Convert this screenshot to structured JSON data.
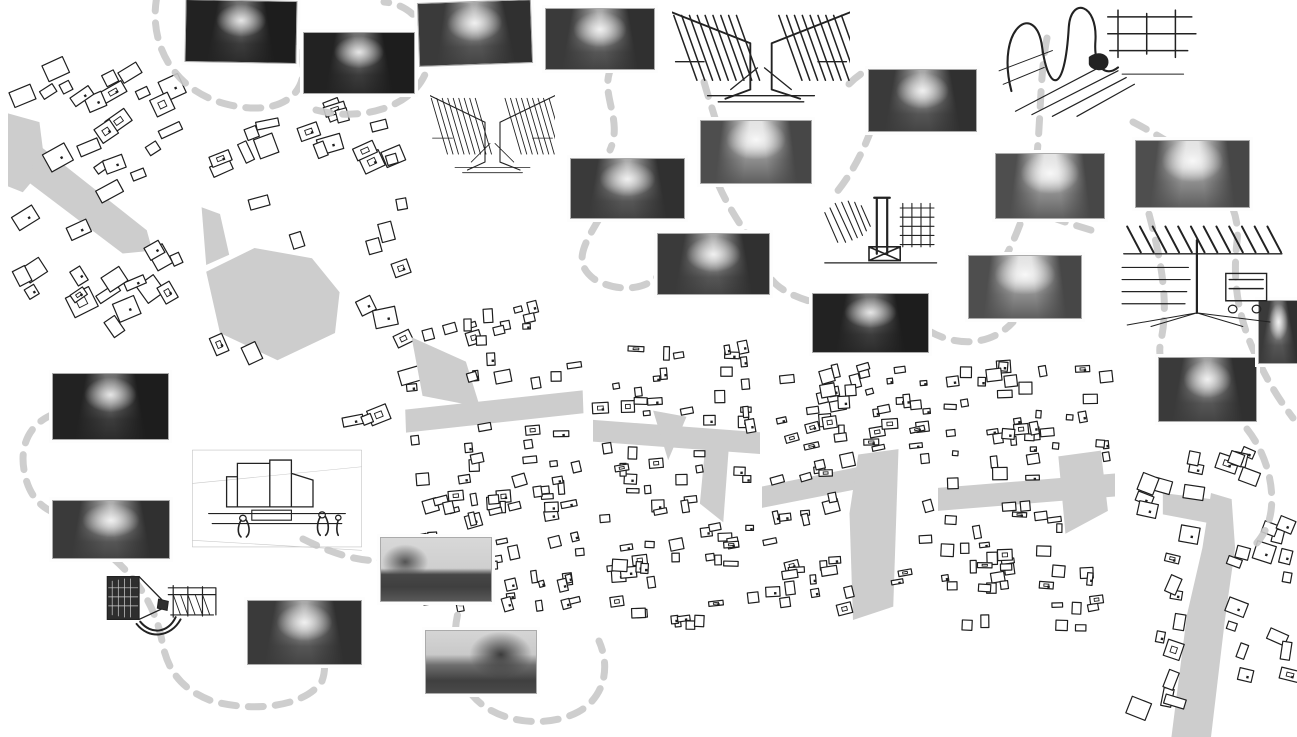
{
  "document": {
    "title": "Urban route analysis collage",
    "description": "Collage of figure-ground urban maps, grayscale street photographs and ink perspective sketches linked by dashed gray route lines",
    "background": "#ffffff"
  },
  "palette": {
    "path_gray": "#c9c9c9",
    "street_gray": "#cdcdcd",
    "ink": "#222222",
    "building_fill": "#ffffff",
    "building_stroke": "#1e1e1e",
    "photo_frame": "#ababab"
  },
  "maps": [
    {
      "id": "figure-ground-map-1",
      "desc": "figure-ground map segment 1, diagonal gray street",
      "x": 8,
      "y": 55,
      "w": 185,
      "h": 292,
      "rot": 0,
      "grain": -28,
      "count": 40,
      "smin": 9,
      "smax": 26,
      "streets": [
        [
          [
            0,
            0.2
          ],
          [
            0.17,
            0.23
          ],
          [
            0.2,
            0.38
          ],
          [
            0.08,
            0.47
          ],
          [
            0,
            0.45
          ]
        ],
        [
          [
            0.15,
            0.3
          ],
          [
            0.75,
            0.6
          ],
          [
            0.78,
            0.67
          ],
          [
            0.62,
            0.68
          ],
          [
            0.12,
            0.44
          ]
        ]
      ]
    },
    {
      "id": "figure-ground-map-2",
      "desc": "figure-ground map segment 2, gray plaza",
      "x": 197,
      "y": 95,
      "w": 230,
      "h": 340,
      "rot": 0,
      "grain": -18,
      "count": 32,
      "smin": 9,
      "smax": 24,
      "streets": [
        [
          [
            0.04,
            0.52
          ],
          [
            0.25,
            0.45
          ],
          [
            0.5,
            0.48
          ],
          [
            0.62,
            0.58
          ],
          [
            0.6,
            0.7
          ],
          [
            0.35,
            0.78
          ],
          [
            0.1,
            0.7
          ]
        ],
        [
          [
            0.02,
            0.33
          ],
          [
            0.1,
            0.35
          ],
          [
            0.14,
            0.47
          ],
          [
            0.04,
            0.5
          ]
        ]
      ]
    },
    {
      "id": "figure-ground-map-3",
      "desc": "figure-ground map segment 3, horizontal gray street",
      "x": 407,
      "y": 295,
      "w": 178,
      "h": 328,
      "rot": -2,
      "grain": -7,
      "count": 85,
      "smin": 5,
      "smax": 16,
      "streets": [
        [
          [
            0.05,
            0.12
          ],
          [
            0.35,
            0.2
          ],
          [
            0.42,
            0.34
          ],
          [
            0.1,
            0.3
          ]
        ],
        [
          [
            0,
            0.34
          ],
          [
            1,
            0.3
          ],
          [
            1,
            0.37
          ],
          [
            0,
            0.41
          ]
        ]
      ]
    },
    {
      "id": "figure-ground-map-4",
      "desc": "figure-ground map segment 4, street with triangular plaza",
      "x": 593,
      "y": 330,
      "w": 167,
      "h": 310,
      "rot": 0,
      "grain": -4,
      "count": 75,
      "smin": 5,
      "smax": 16,
      "streets": [
        [
          [
            0,
            0.29
          ],
          [
            1,
            0.33
          ],
          [
            1,
            0.4
          ],
          [
            0,
            0.36
          ]
        ],
        [
          [
            0.36,
            0.26
          ],
          [
            0.56,
            0.28
          ],
          [
            0.45,
            0.42
          ]
        ],
        [
          [
            0.68,
            0.33
          ],
          [
            0.82,
            0.33
          ],
          [
            0.78,
            0.62
          ],
          [
            0.64,
            0.56
          ]
        ]
      ]
    },
    {
      "id": "figure-ground-map-5",
      "desc": "figure-ground map segment 5, street widening to gray boulevard",
      "x": 762,
      "y": 353,
      "w": 175,
      "h": 267,
      "rot": 0,
      "grain": -9,
      "count": 70,
      "smin": 5,
      "smax": 16,
      "streets": [
        [
          [
            0,
            0.5
          ],
          [
            0.6,
            0.42
          ],
          [
            0.62,
            0.5
          ],
          [
            0,
            0.58
          ]
        ],
        [
          [
            0.55,
            0.38
          ],
          [
            0.78,
            0.36
          ],
          [
            0.75,
            0.95
          ],
          [
            0.52,
            1
          ],
          [
            0.5,
            0.6
          ]
        ]
      ]
    },
    {
      "id": "figure-ground-map-6",
      "desc": "figure-ground map segment 6, cross street with gray block",
      "x": 938,
      "y": 353,
      "w": 177,
      "h": 287,
      "rot": 0,
      "grain": -3,
      "count": 78,
      "smin": 5,
      "smax": 15,
      "streets": [
        [
          [
            0,
            0.47
          ],
          [
            1,
            0.42
          ],
          [
            1,
            0.5
          ],
          [
            0,
            0.55
          ]
        ],
        [
          [
            0.68,
            0.36
          ],
          [
            0.92,
            0.34
          ],
          [
            0.96,
            0.55
          ],
          [
            0.72,
            0.63
          ]
        ]
      ]
    },
    {
      "id": "figure-ground-map-7",
      "desc": "figure-ground map segment 7, fanning gray route to the south",
      "x": 1125,
      "y": 432,
      "w": 172,
      "h": 305,
      "rot": 0,
      "grain": 16,
      "count": 38,
      "smin": 8,
      "smax": 22,
      "streets": [
        [
          [
            0.5,
            0.2
          ],
          [
            0.62,
            0.22
          ],
          [
            0.64,
            0.38
          ],
          [
            0.58,
            0.62
          ],
          [
            0.5,
            1
          ],
          [
            0.27,
            1
          ],
          [
            0.36,
            0.6
          ],
          [
            0.45,
            0.38
          ]
        ],
        [
          [
            0.22,
            0.2
          ],
          [
            0.5,
            0.22
          ],
          [
            0.5,
            0.3
          ],
          [
            0.22,
            0.27
          ]
        ]
      ]
    }
  ],
  "photos": [
    {
      "id": "street-photo-1",
      "desc": "narrow market street with pedestrians",
      "x": 185,
      "y": 0,
      "w": 110,
      "h": 61,
      "rot": 1,
      "tone": "dark"
    },
    {
      "id": "street-photo-2",
      "desc": "shaded shopping street",
      "x": 303,
      "y": 32,
      "w": 110,
      "h": 60,
      "rot": 0,
      "tone": "dark"
    },
    {
      "id": "street-photo-3",
      "desc": "street corner with storefronts",
      "x": 418,
      "y": 1,
      "w": 112,
      "h": 62,
      "rot": -2,
      "tone": "mid"
    },
    {
      "id": "street-photo-4",
      "desc": "street with parked cars",
      "x": 545,
      "y": 8,
      "w": 108,
      "h": 60,
      "rot": 0,
      "tone": "mid"
    },
    {
      "id": "street-photo-5",
      "desc": "corner building on narrow street",
      "x": 868,
      "y": 69,
      "w": 107,
      "h": 61,
      "rot": 0,
      "tone": "mid"
    },
    {
      "id": "street-photo-6",
      "desc": "crosswalk intersection",
      "x": 700,
      "y": 120,
      "w": 110,
      "h": 62,
      "rot": 0,
      "tone": "light"
    },
    {
      "id": "street-photo-7",
      "desc": "shopping street with cyclist",
      "x": 570,
      "y": 158,
      "w": 113,
      "h": 59,
      "rot": 0,
      "tone": "mid"
    },
    {
      "id": "street-photo-8",
      "desc": "tree-lined avenue with traffic",
      "x": 995,
      "y": 153,
      "w": 108,
      "h": 64,
      "rot": 0,
      "tone": "light"
    },
    {
      "id": "street-photo-9",
      "desc": "grand boulevard with open sky",
      "x": 1135,
      "y": 140,
      "w": 113,
      "h": 66,
      "rot": 0,
      "tone": "light"
    },
    {
      "id": "street-photo-10",
      "desc": "street canyon with balconies",
      "x": 657,
      "y": 233,
      "w": 111,
      "h": 60,
      "rot": 0,
      "tone": "mid"
    },
    {
      "id": "street-photo-11",
      "desc": "intersection with street trees",
      "x": 968,
      "y": 255,
      "w": 112,
      "h": 62,
      "rot": 0,
      "tone": "light"
    },
    {
      "id": "street-photo-12",
      "desc": "dark shopfront awnings",
      "x": 812,
      "y": 293,
      "w": 115,
      "h": 58,
      "rot": 0,
      "tone": "dark"
    },
    {
      "id": "street-photo-13",
      "desc": "shopping street with motorbike",
      "x": 1158,
      "y": 357,
      "w": 97,
      "h": 63,
      "rot": 0,
      "tone": "mid"
    },
    {
      "id": "street-photo-14",
      "desc": "tree-covered street at dusk",
      "x": 52,
      "y": 373,
      "w": 115,
      "h": 65,
      "rot": 0,
      "tone": "dark"
    },
    {
      "id": "street-photo-15",
      "desc": "stone facade street",
      "x": 52,
      "y": 500,
      "w": 116,
      "h": 57,
      "rot": 0,
      "tone": "mid"
    },
    {
      "id": "street-photo-16",
      "desc": "crowded street with scaffolding arch",
      "x": 247,
      "y": 600,
      "w": 113,
      "h": 63,
      "rot": 0,
      "tone": "mid"
    },
    {
      "id": "street-photo-17",
      "desc": "plaza with crowd and curved building",
      "x": 380,
      "y": 537,
      "w": 110,
      "h": 63,
      "rot": 0,
      "tone": "plaza"
    },
    {
      "id": "street-photo-18",
      "desc": "market hall canopy with people",
      "x": 425,
      "y": 630,
      "w": 110,
      "h": 62,
      "rot": 0,
      "tone": "market"
    },
    {
      "id": "street-photo-19",
      "desc": "street photo cropped at right edge",
      "x": 1258,
      "y": 300,
      "w": 39,
      "h": 62,
      "rot": 0,
      "tone": "mid"
    }
  ],
  "sketches": [
    {
      "id": "sketch-street-canyon",
      "desc": "hatched perspective sketch of a street canyon",
      "style": "hatch",
      "weight": 1,
      "x": 430,
      "y": 85,
      "w": 125,
      "h": 93
    },
    {
      "id": "sketch-covered-street",
      "desc": "bold hatched sketch of a covered street",
      "style": "hatch",
      "weight": 1.7,
      "x": 672,
      "y": 0,
      "w": 178,
      "h": 108
    },
    {
      "id": "sketch-gestural-boulevard",
      "desc": "gestural ink sketch of boulevard structures",
      "style": "gesture",
      "weight": 1,
      "x": 995,
      "y": 0,
      "w": 205,
      "h": 118
    },
    {
      "id": "sketch-kiosk",
      "desc": "sketch of kiosk and street furniture",
      "style": "kiosk",
      "weight": 1,
      "x": 817,
      "y": 192,
      "w": 130,
      "h": 80
    },
    {
      "id": "sketch-awning",
      "desc": "sketch of awning over sidewalk with cart",
      "style": "awning",
      "weight": 1,
      "x": 1117,
      "y": 222,
      "w": 170,
      "h": 106
    },
    {
      "id": "sketch-rooftop-terrace",
      "desc": "light line sketch of rooftop terrace with figures",
      "style": "rooftop",
      "weight": 1,
      "x": 187,
      "y": 440,
      "w": 180,
      "h": 117
    },
    {
      "id": "sketch-double-perspective",
      "desc": "double-perspective sketch pinched at vanishing point",
      "style": "bowtie",
      "weight": 1,
      "x": 100,
      "y": 563,
      "w": 122,
      "h": 79
    }
  ],
  "paths": [
    {
      "id": "route-dash-1",
      "d": "M157,-4 C148,42 172,90 226,104 C288,120 316,86 298,46 C288,24 266,10 244,12"
    },
    {
      "id": "route-dash-2",
      "d": "M316,110 C368,124 426,102 429,58 C431,26 410,4 384,2"
    },
    {
      "id": "route-dash-3",
      "d": "M612,66 C598,94 624,118 610,150"
    },
    {
      "id": "route-dash-4",
      "d": "M599,219 C583,246 573,263 594,279 C620,294 646,288 657,277"
    },
    {
      "id": "route-dash-5",
      "d": "M704,82 C708,96 712,108 715,118"
    },
    {
      "id": "route-dash-6",
      "d": "M719,186 C734,220 757,245 767,271 C772,286 790,295 809,301"
    },
    {
      "id": "route-dash-7",
      "d": "M929,331 C957,347 991,346 1013,322"
    },
    {
      "id": "route-dash-8",
      "d": "M1047,38 C1037,88 1043,158 1028,200 C1021,224 1014,240 1007,254"
    },
    {
      "id": "route-dash-9",
      "d": "M871,130 C861,157 849,177 836,193"
    },
    {
      "id": "route-dash-10",
      "d": "M849,84 C854,79 859,75 864,72"
    },
    {
      "id": "route-dash-11",
      "d": "M1051,217 C1067,223 1081,227 1094,231"
    },
    {
      "id": "route-dash-12",
      "d": "M1133,122 C1190,152 1243,188 1237,242 C1231,292 1243,330 1259,362 C1269,384 1281,402 1293,418"
    },
    {
      "id": "route-dash-13",
      "d": "M1149,214 C1159,252 1170,300 1161,340 C1156,362 1167,381 1178,394"
    },
    {
      "id": "route-dash-14",
      "d": "M1247,429 C1263,449 1275,481 1271,511 C1269,526 1262,539 1251,549"
    },
    {
      "id": "route-dash-15",
      "d": "M54,414 C28,424 20,447 24,470 C28,496 42,509 58,514"
    },
    {
      "id": "route-dash-16",
      "d": "M114,559 C134,577 154,601 162,641 C167,669 180,689 212,701 C256,713 306,706 322,681 C329,662 321,640 307,622"
    },
    {
      "id": "route-dash-17",
      "d": "M303,539 C341,558 367,562 382,560"
    },
    {
      "id": "route-dash-18",
      "d": "M467,590 C449,620 452,669 473,696 C496,723 546,729 578,712 C604,698 611,668 599,641"
    }
  ]
}
